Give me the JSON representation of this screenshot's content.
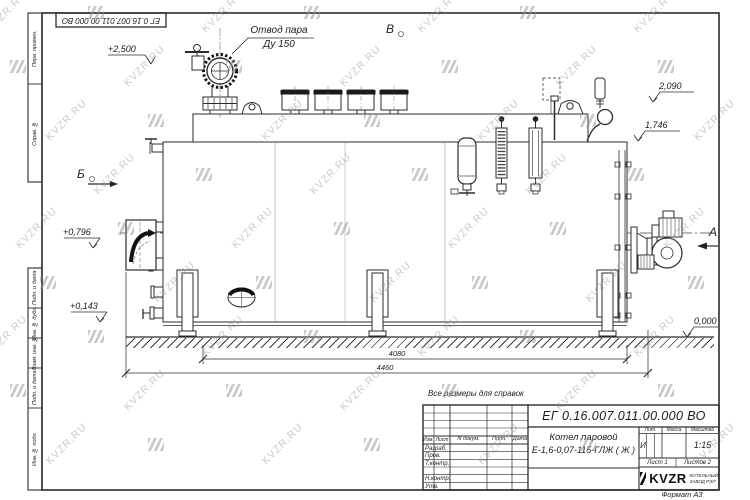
{
  "watermark": {
    "text": "KVZR.RU"
  },
  "frame": {
    "top_designation": "ЕГ 0.16.007.011.00.000  ВО",
    "margin_top": [
      "Перв. примен.",
      "Справ. №"
    ],
    "margin_bottom": [
      "Подп. и дата",
      "Инв. № дубл.",
      "Взам. инв. №",
      "Подп. и дата",
      "Инв. № подл."
    ]
  },
  "annotations": {
    "steam_outlet": {
      "line1": "Отвод пара",
      "line2": "Ду 150"
    },
    "levels": {
      "l2500": "+2,500",
      "l2090": "2,090",
      "l1746": "1,746",
      "l0796": "+0,796",
      "l0143": "+0,143",
      "l0000": "0,000"
    },
    "views": {
      "b": "В",
      "bb": "Б",
      "a": "А"
    },
    "dims": {
      "d4080": "4080",
      "d4460": "4460"
    },
    "note": "Все размеры для справок"
  },
  "title_block": {
    "designation": "ЕГ 0.16.007.011.00.000  ВО",
    "product_name_line1": "Котел паровой",
    "product_name_line2": "Е-1,6-0,07-115-ГЛЖ ( Ж )",
    "columns": {
      "izm": "Изм.",
      "list": "Лист",
      "ndokum": "N докум.",
      "podp": "Подп.",
      "data": "Дата"
    },
    "rows": {
      "razrab": "Разраб.",
      "prov": "Пров.",
      "tkontr": "Т.контр.",
      "nkontr": "Н.контр.",
      "utv": "Утв."
    },
    "lit_label": "Лит.",
    "massa_label": "Масса",
    "masshtab_label": "Масштаб",
    "lit_value": "И",
    "scale": "1:15",
    "sheet": "Лист 1",
    "sheets_total": "Листов 2",
    "company": {
      "logo": "KVZR",
      "sub1": "КОТЕЛЬНЫЙ",
      "sub2": "ЗАВОД РЭП"
    },
    "format": "Формат А3"
  }
}
